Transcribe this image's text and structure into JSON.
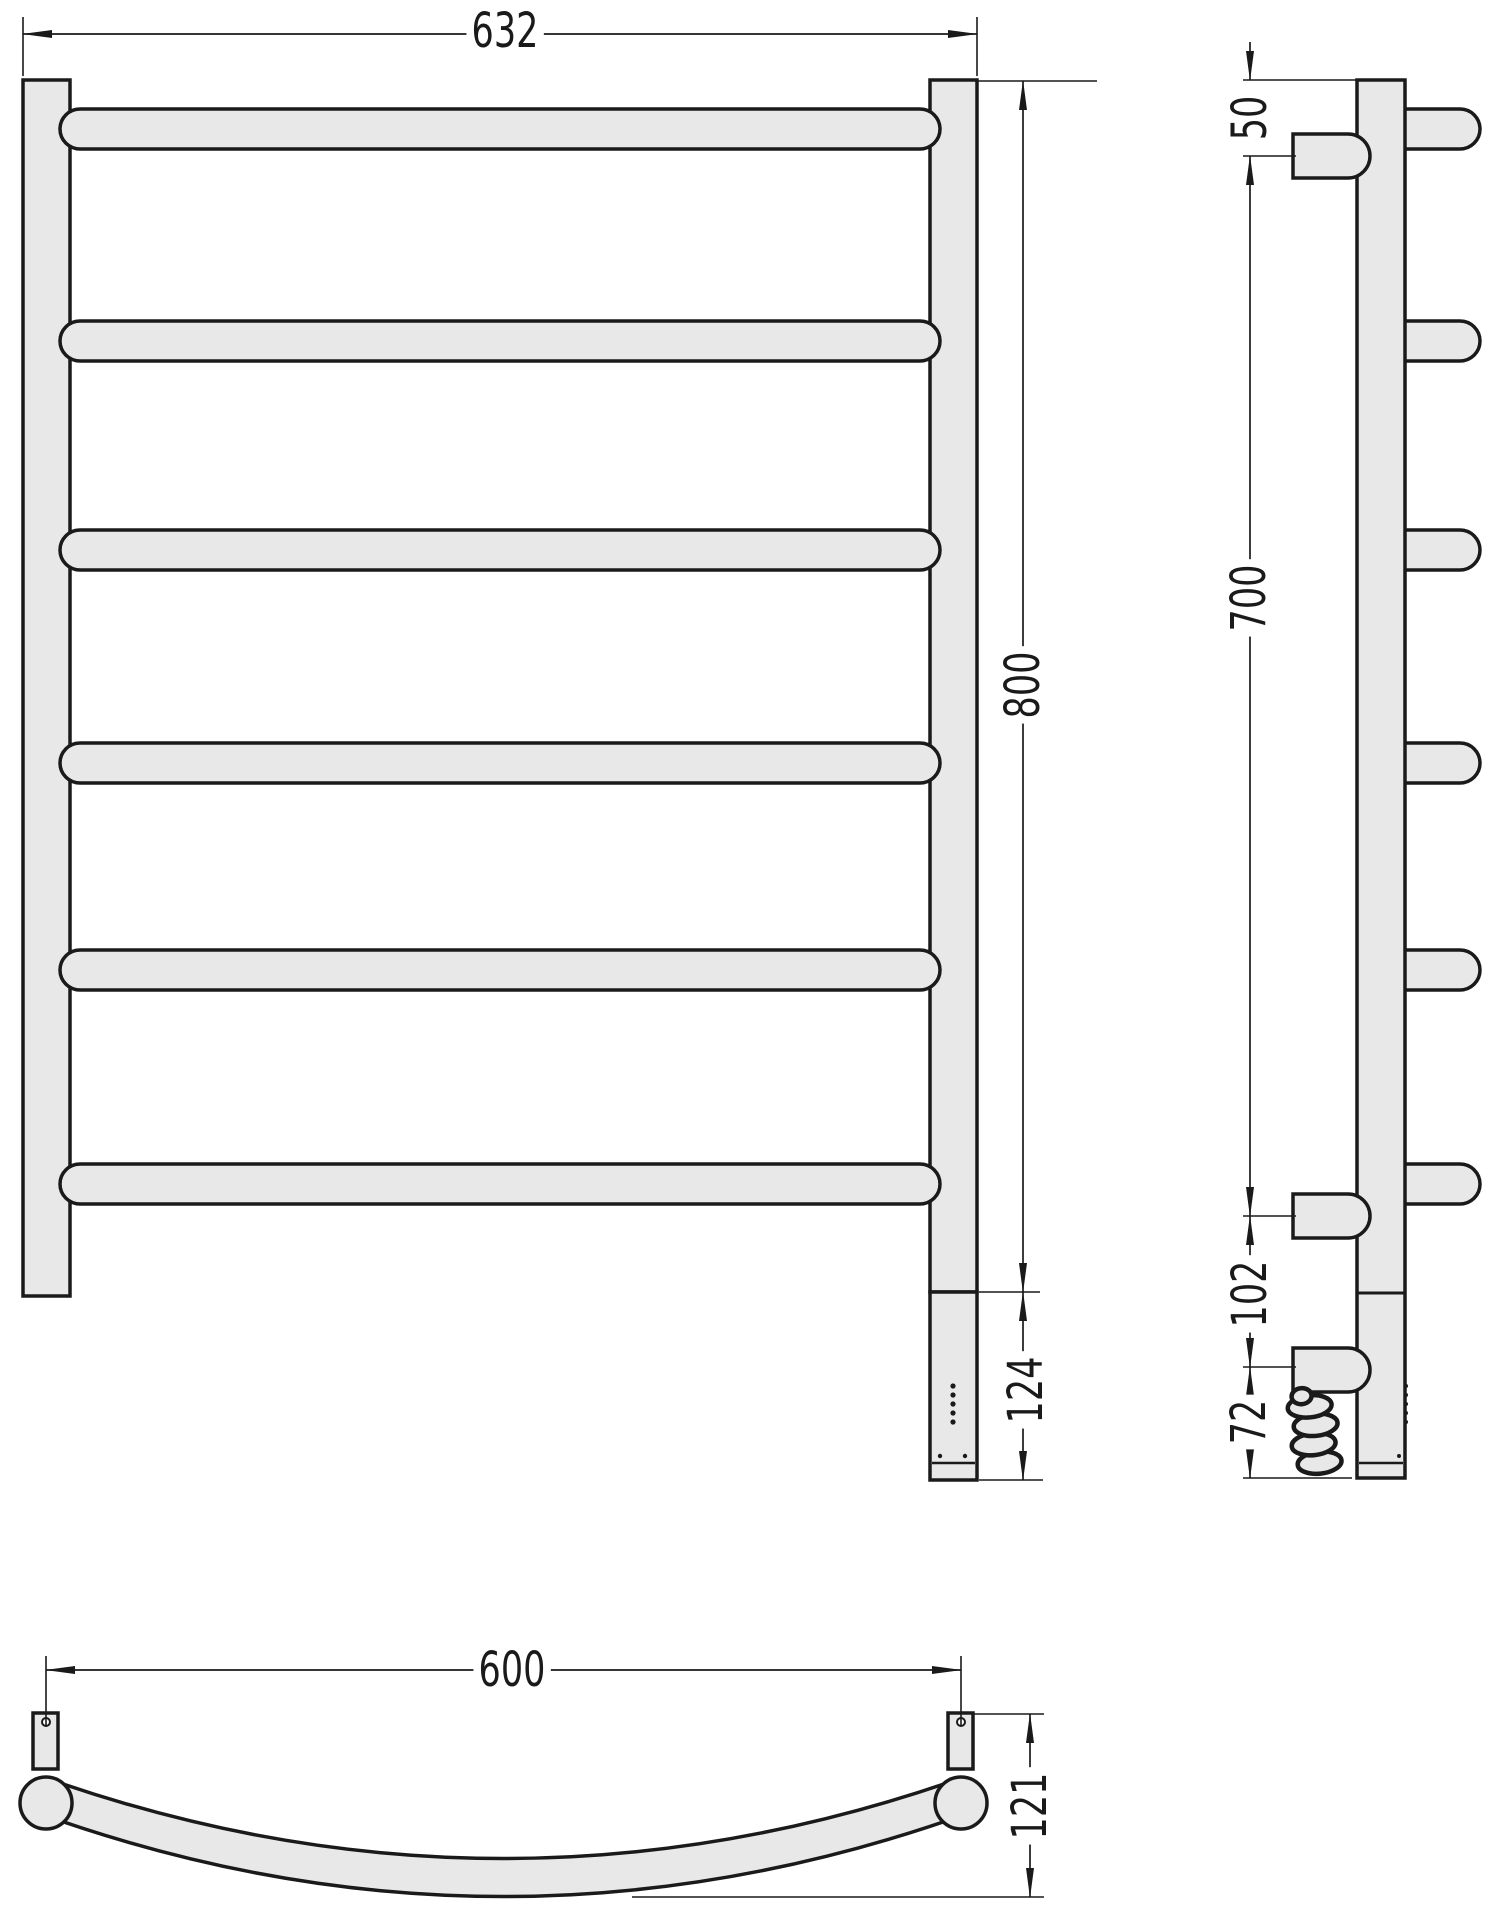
{
  "title": "Heated towel rail technical drawing (front, side and plan views)",
  "colors": {
    "background": "#ffffff",
    "fill": "#e8e8e8",
    "line": "#1a1a1a"
  },
  "dims": {
    "front_width": "632",
    "front_height": "800",
    "front_bottom_section": "124",
    "side_top_offset": "50",
    "side_rail_span": "700",
    "side_lower_gap": "102",
    "side_bottom_offset": "72",
    "plan_width": "600",
    "plan_depth": "121"
  }
}
